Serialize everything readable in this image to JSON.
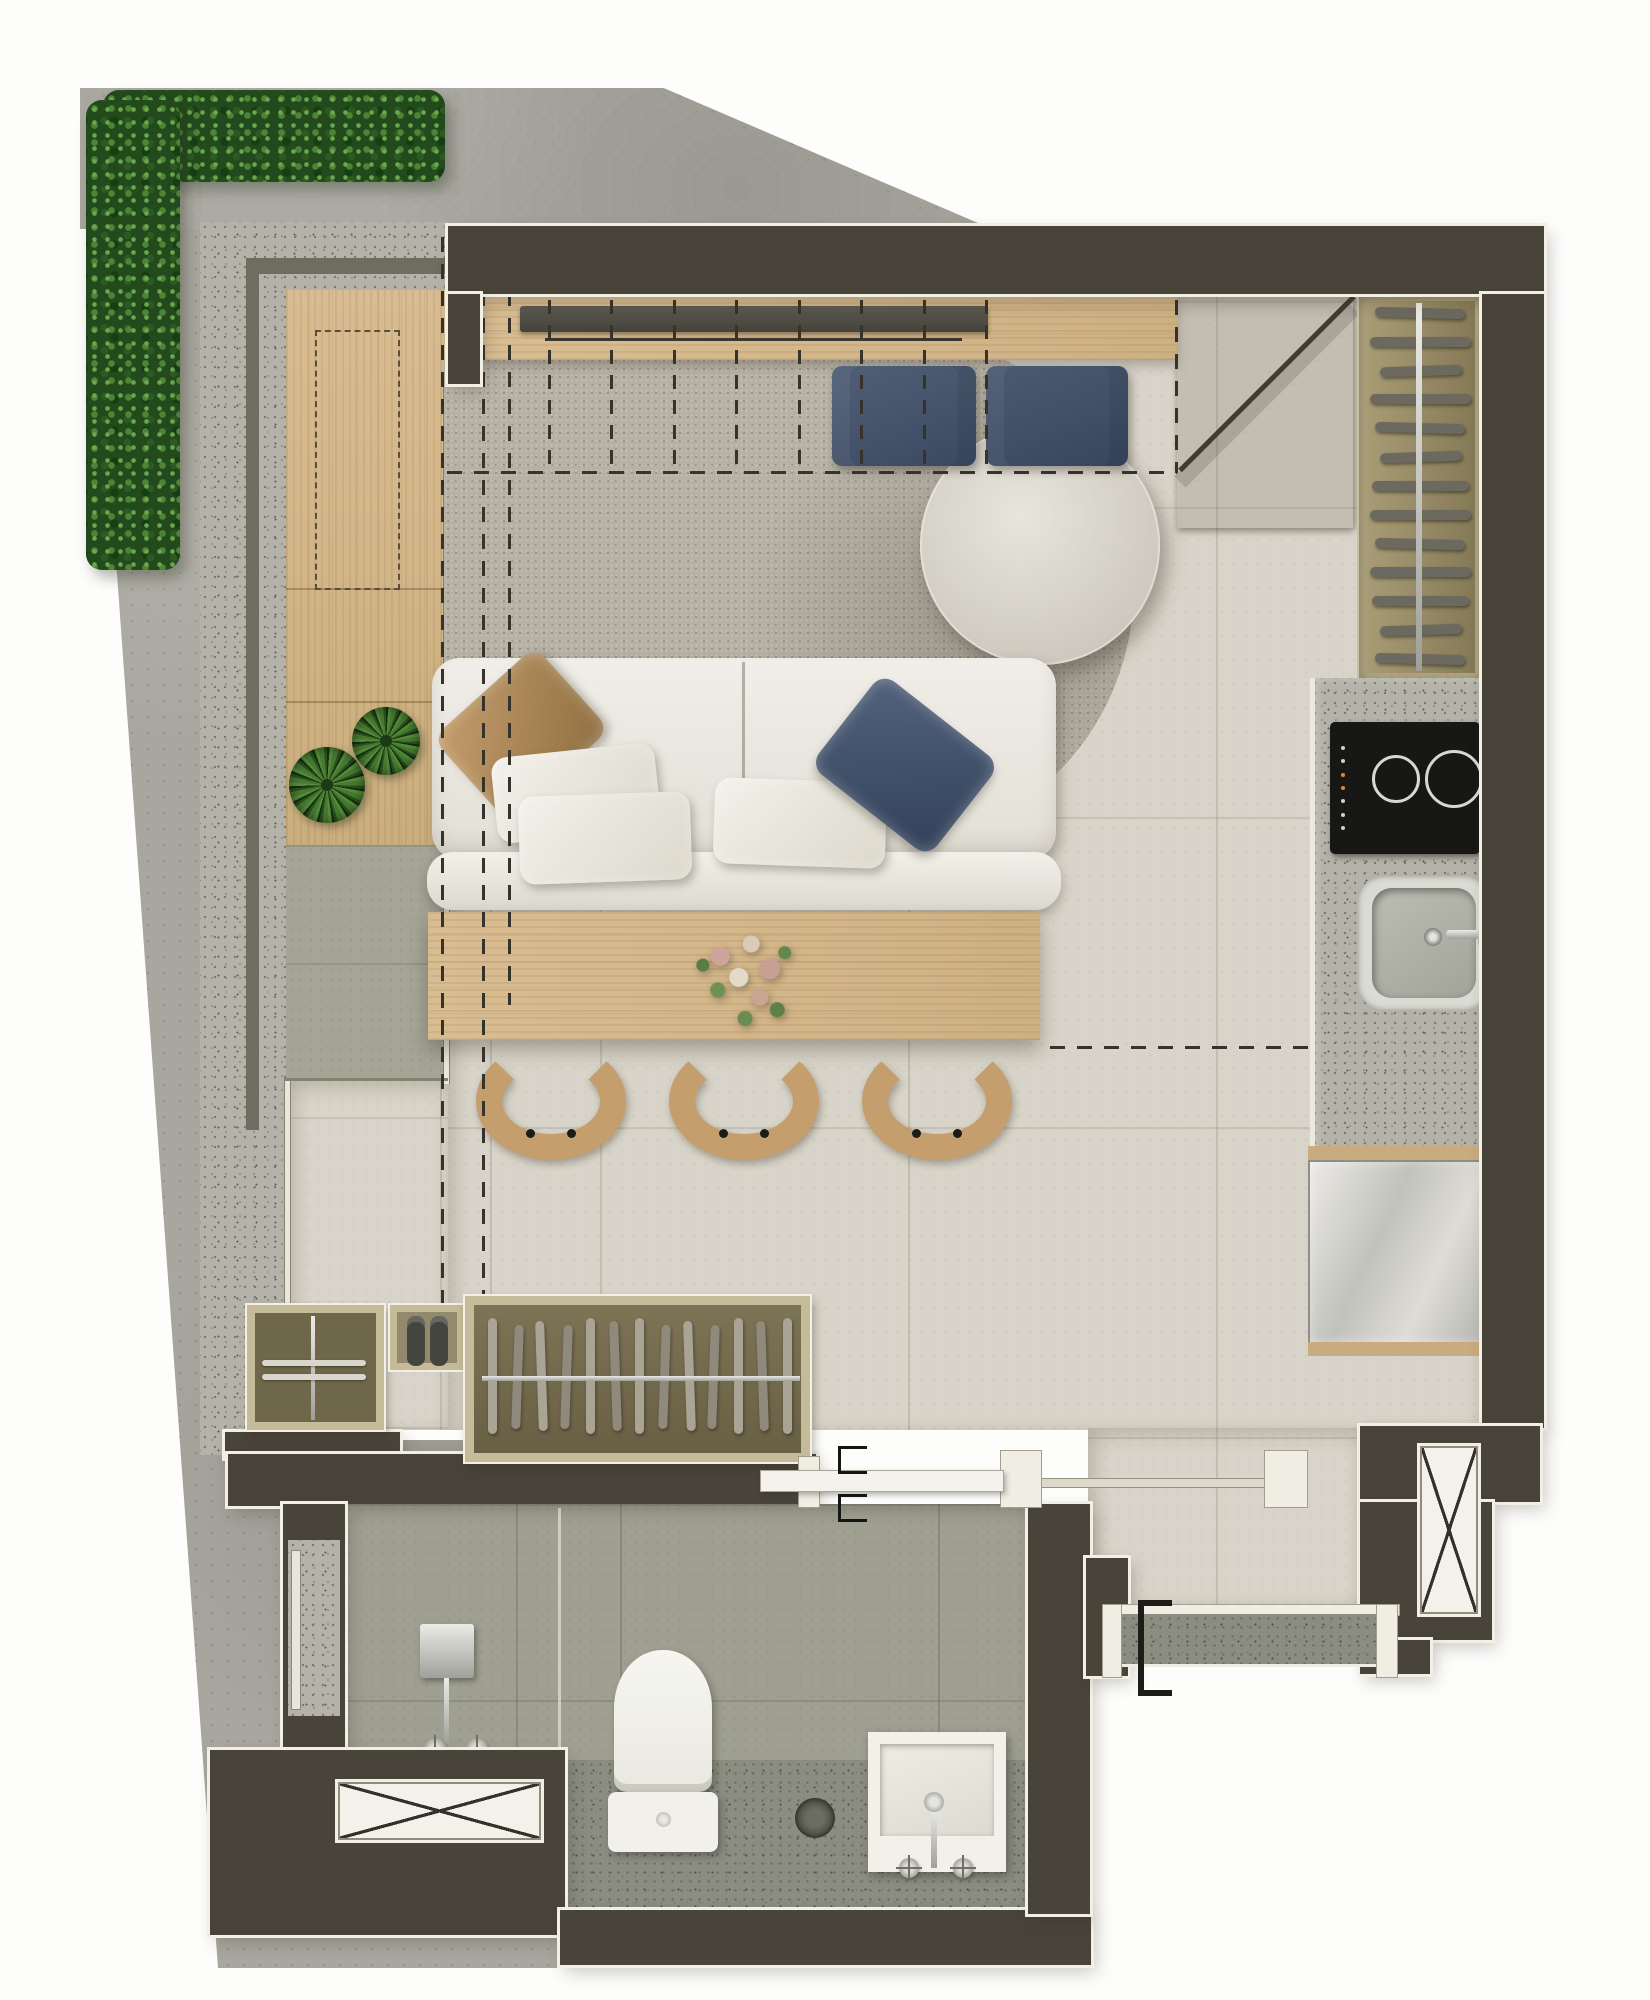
{
  "plan": {
    "type": "apartment-floor-plan-top-view",
    "rooms": [
      "balcony-terrace",
      "living-dining",
      "kitchenette",
      "entry",
      "closet",
      "bathroom",
      "service-corridor"
    ],
    "furniture": [
      "tv-console",
      "floor-cushions",
      "rug",
      "round-coffee-table",
      "two-seat-sofa",
      "dining-table",
      "dining-chairs",
      "sideboard-with-plants",
      "shelf-rack",
      "cooktop",
      "kitchen-sink",
      "refrigerator",
      "wardrobe",
      "shoe-cabinet",
      "shower",
      "toilet",
      "wall-hung-basin",
      "laundry-tank"
    ]
  },
  "counts": {
    "shelf_bars": 13,
    "wardrobe_hangers": 13,
    "small_rail_hangers": 2,
    "dining_chairs": 3,
    "window_comb_lines": 8,
    "cooktop_burners": 2,
    "control_dots": 7
  },
  "palette": {
    "wall": "#48443a",
    "outline": "#f2efe4",
    "concrete": "#a8a69e",
    "granite": "#b5b3a9",
    "graniteDark": "#8b8d80",
    "tile": "#d8d4c9",
    "bathTile": "#9fa092",
    "balconyTile": "#a4a497",
    "wood": "#d9bd92",
    "woodDark": "#c9a87a",
    "sofa": "#ebe9e2",
    "rug": "#b6b1a4",
    "navy": "#32405a",
    "tan": "#b08a5c",
    "chair": "#c49e6c",
    "dash": "#35332a",
    "hedge": "#234a1c",
    "cooktop": "#171715",
    "steel": "#d6d6d0",
    "chrome": "#c7c7c1"
  }
}
